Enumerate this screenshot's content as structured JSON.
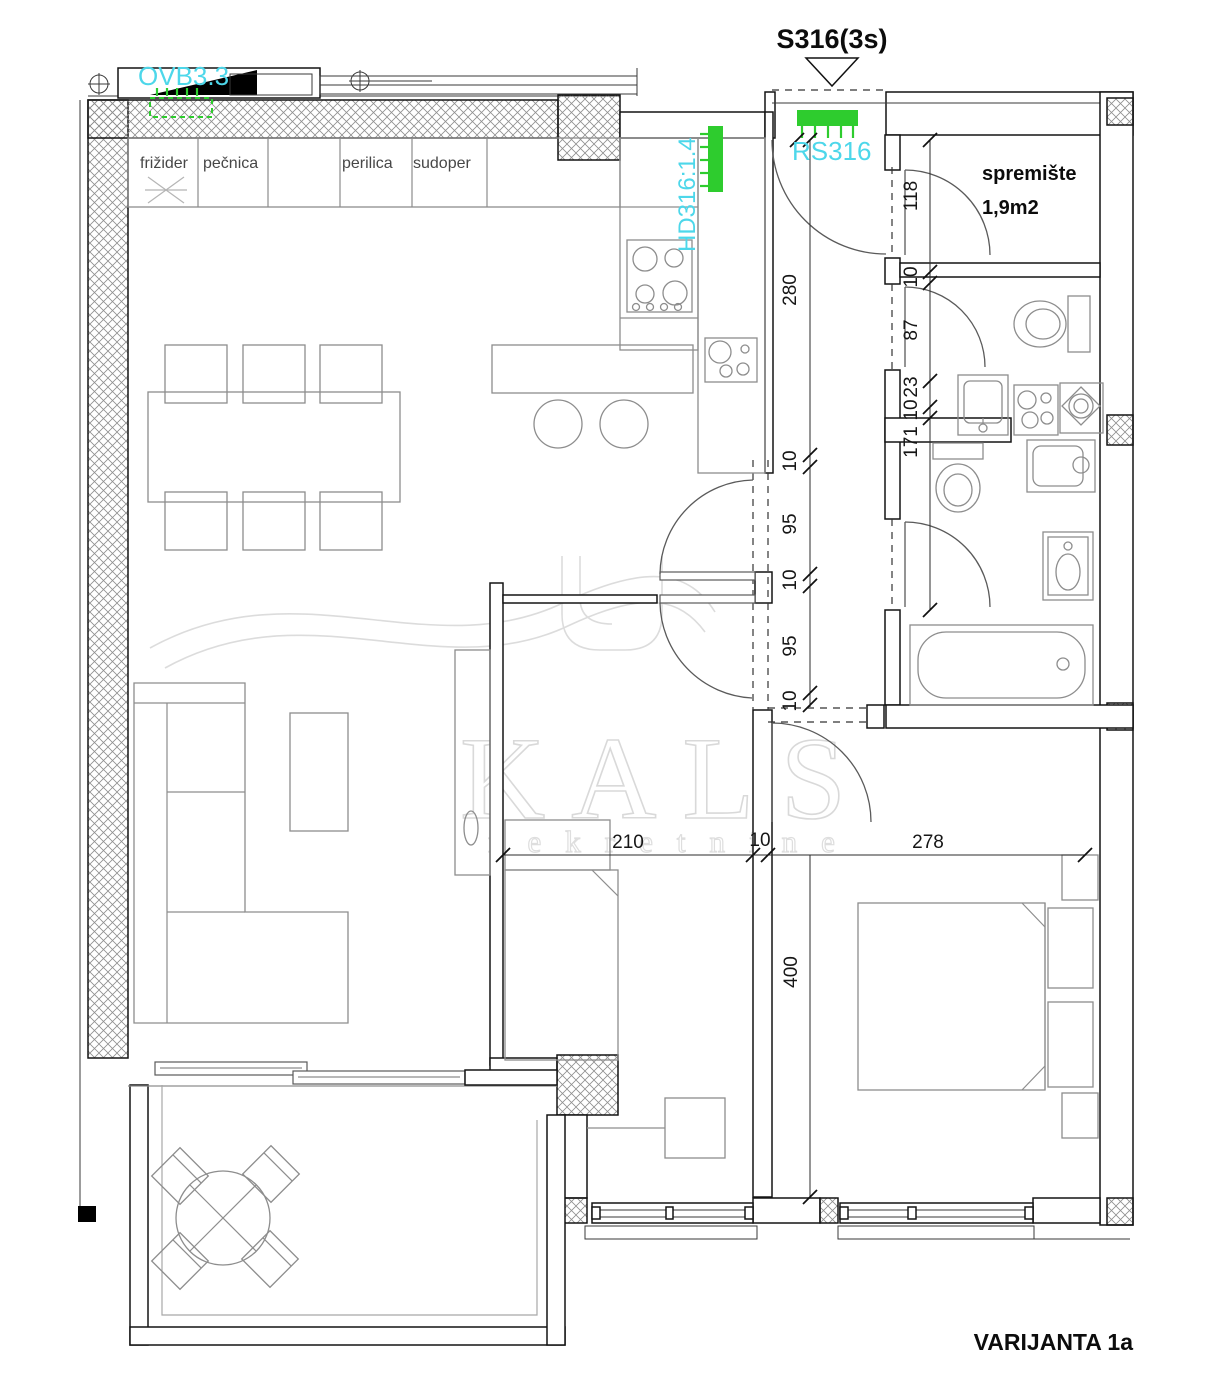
{
  "header": {
    "unit_code": "S316(3s)",
    "variant_label": "VARIJANTA 1a"
  },
  "annotations": {
    "vent_label": "OVB3.3",
    "radiator_label": "RS316",
    "duct_label": "HD316:1.4"
  },
  "rooms": {
    "storage_name": "spremište",
    "storage_area": "1,9m2"
  },
  "kitchen": {
    "appliances": [
      "frižider",
      "pečnica",
      "perilica",
      "sudoper"
    ]
  },
  "dimensions": {
    "corridor_chain": [
      "280",
      "10",
      "95",
      "10",
      "95",
      "10"
    ],
    "right_chain": [
      "118",
      "10",
      "87",
      "23",
      "10",
      "171"
    ],
    "bottom_chain": [
      "210",
      "10",
      "278"
    ],
    "bedroom_depth": "400"
  },
  "watermark": {
    "brand": "KALS",
    "subtitle": "nekretnine"
  },
  "colors": {
    "annotation_cyan": "#4dd7ea",
    "element_green": "#2ecc2e"
  }
}
